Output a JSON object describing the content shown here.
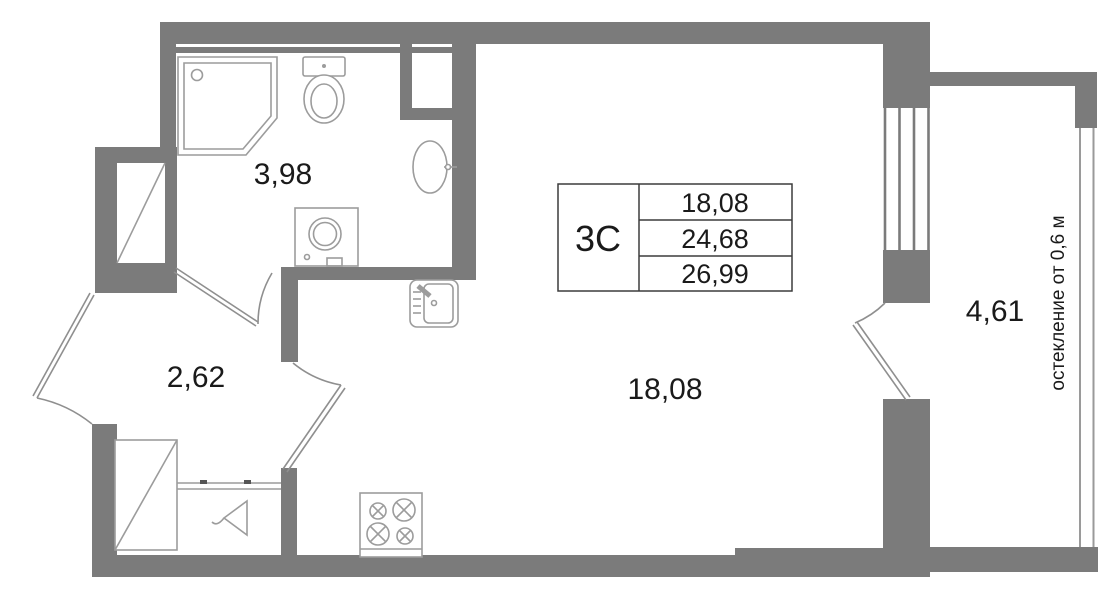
{
  "unit": {
    "type_label": "3С",
    "areas": {
      "row1": "18,08",
      "row2": "24,68",
      "row3": "26,99"
    }
  },
  "rooms": {
    "bathroom": {
      "area": "3,98"
    },
    "hallway": {
      "area": "2,62"
    },
    "living": {
      "area": "18,08"
    },
    "balcony": {
      "area": "4,61"
    }
  },
  "notes": {
    "glazing": "остекление от 0,6 м"
  },
  "colors": {
    "wall": "#7b7b7b",
    "fixture_line": "#9c9c9c",
    "door_line": "#8f8f8f",
    "table_border": "#3c3c3c",
    "text": "#1a1a1a",
    "background": "#ffffff"
  }
}
